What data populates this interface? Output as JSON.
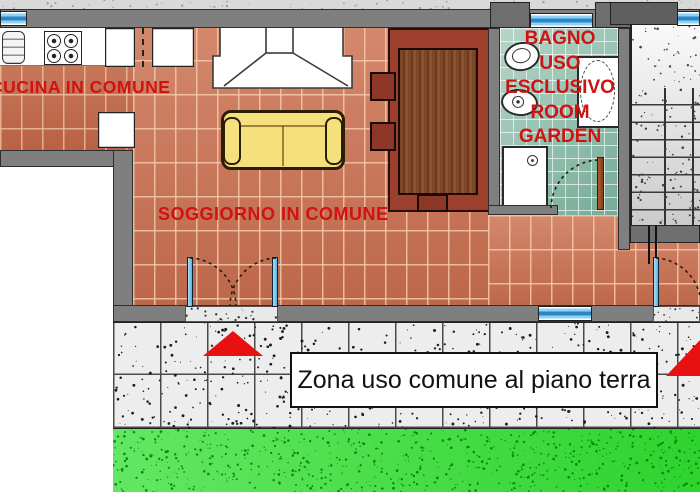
{
  "page": {
    "type": "apartment-floor-plan"
  },
  "labels": {
    "kitchen": "CUCINA IN COMUNE",
    "living_room": "SOGGIORNO IN COMUNE",
    "bathroom": [
      "BAGNO",
      "USO",
      "ESCLUSIVO",
      "ROOM",
      "GARDEN"
    ],
    "ground_floor_zone": "Zona uso comune al piano terra"
  },
  "colors": {
    "label-red": "#d01212",
    "terracotta": "#c97a5c",
    "bath-teal": "#8fbfae",
    "wall-gray": "#7f7f7f",
    "wall-dark": "#5f5f5f",
    "pavement-gray": "#ededed",
    "grass-green": "#2ed32e",
    "door-blue": "#3fa9e0",
    "sofa-yellow": "#f5e07c",
    "table-wood": "#7d4626",
    "mat-red": "#9c3f2c",
    "arrow-red": "#e81010",
    "window-blue": "#5db9ec"
  },
  "icons": {
    "stove": "gas-stove-4-burners",
    "sink": "kitchen-sink",
    "fireplace": "fireplace-hood",
    "sofa": "sofa",
    "table": "wooden-dining-table",
    "chairs": "dining-chairs",
    "toilet": "toilet",
    "bidet": "bidet",
    "bathtub": "bathtub",
    "shower": "shower-tray",
    "stairs": "staircase",
    "doors": "swing-doors",
    "windows": "windows",
    "arrows": "entrance-arrows",
    "grass": "garden-lawn",
    "pavement": "outdoor-paving"
  }
}
